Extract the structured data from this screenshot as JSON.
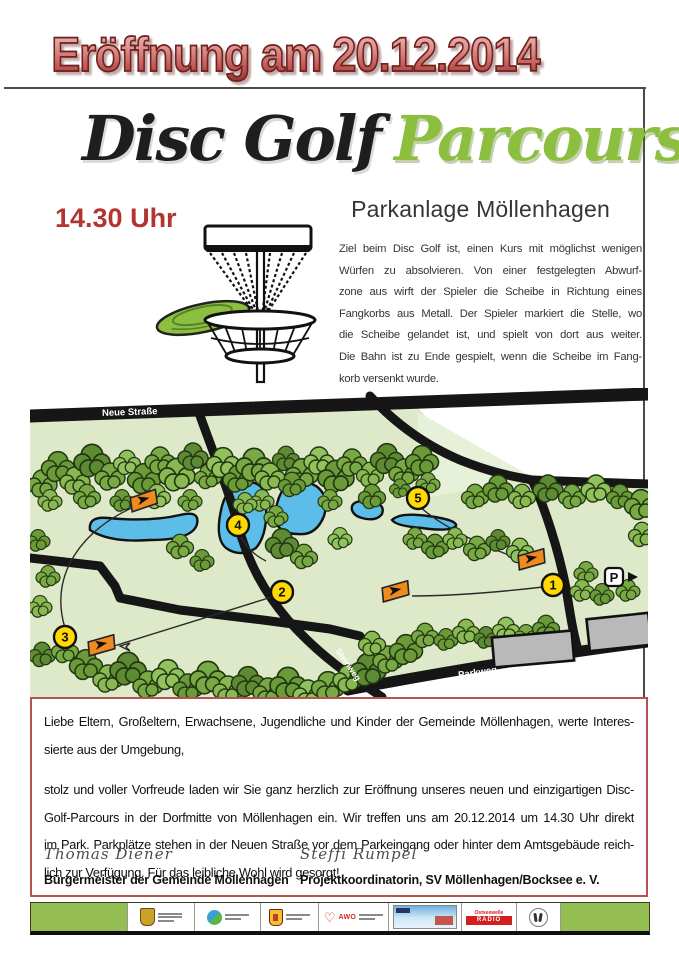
{
  "poster": {
    "title": "Eröffnung am 20.12.2014",
    "heading_black": "Disc Golf",
    "heading_green": "Parcours",
    "subtitle": "Parkanlage Möllenhagen",
    "time": "14.30 Uhr",
    "description_lines": [
      "Ziel beim Disc Golf ist, einen Kurs mit möglichst wenigen",
      "Würfen zu absolvieren. Von einer festgelegten Abwurf-",
      "zone aus wirft der Spieler die Scheibe in Richtung eines",
      "Fangkorbs aus Metall. Der Spieler markiert die Stelle, wo",
      "die Scheibe gelandet ist, und spielt von dort aus weiter.",
      "Die Bahn ist zu Ende gespielt, wenn die Scheibe im Fang-",
      "korb versenkt wurde."
    ]
  },
  "map": {
    "streets": {
      "top": "Neue Straße",
      "diagonal": "Steinweg",
      "bottom": "Parkweg"
    },
    "parking_label": "P",
    "holes": [
      "1",
      "2",
      "3",
      "4",
      "5"
    ]
  },
  "invitation": {
    "paragraph1_lines": [
      "Liebe Eltern, Großeltern, Erwachsene, Jugendliche und Kinder der Gemeinde Möllenhagen, werte Interes-",
      "sierte aus der Umgebung,"
    ],
    "paragraph2_lines": [
      "stolz und voller Vorfreude laden wir Sie  ganz herzlich zur Eröffnung unseres neuen und einzigartigen Disc-",
      "Golf-Parcours in der Dorfmitte von Möllenhagen ein.  Wir treffen uns am 20.12.2014 um 14.30 Uhr direkt",
      "im Park. Parkplätze stehen in der Neuen Straße vor dem Parkeingang oder hinter dem Amtsgebäude reich-",
      "lich zur Verfügung. Für das leibliche Wohl wird gesorgt!"
    ],
    "signature1": {
      "name": "Thomas Diener",
      "role": "Bürgermeister der Gemeinde Möllenhagen"
    },
    "signature2": {
      "name": "Steffi Rumpel",
      "role": "Projektkoordinatorin, SV Möllenhagen/Bocksee e. V."
    }
  },
  "footer": {
    "awo_label": "AWO",
    "radio_line1": "Ostseewelle",
    "radio_line2": "RADIO"
  },
  "colors": {
    "title_red": "#b0423e",
    "accent_green": "#8cbf3f",
    "box_border_red": "#b2544f",
    "footer_green": "#94bd52",
    "pond_blue": "#5bbde8",
    "hole_yellow": "#ffd900",
    "flag_orange": "#ef8a1f"
  }
}
